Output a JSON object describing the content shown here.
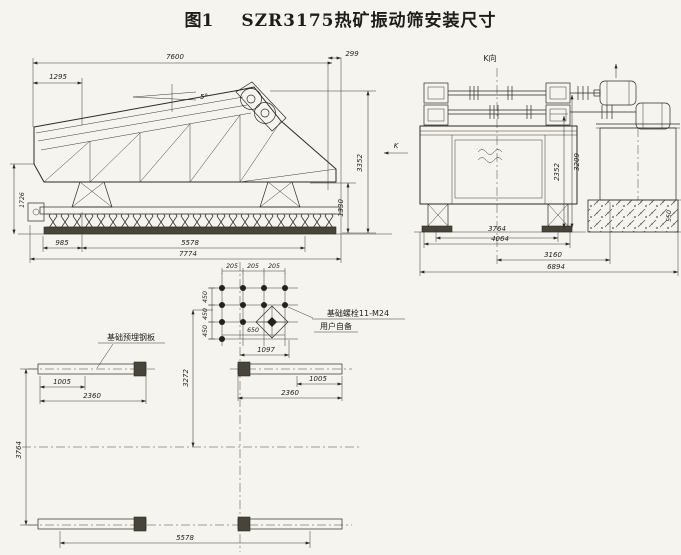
{
  "palette": {
    "paper": "#f6f4ee",
    "ink": "#2b2a26"
  },
  "figure": {
    "label": "图1",
    "title": "SZR3175热矿振动筛安装尺寸"
  },
  "side_view": {
    "k_marker": "K",
    "dims": {
      "overall_length": "7600",
      "feed_offset": "1295",
      "rear_offset": "299",
      "incline_angle": "5°",
      "overall_height": "3352",
      "discharge_height": "1330",
      "left_height": "1726",
      "base_front": "985",
      "base_span": "5578",
      "base_overall": "7774"
    }
  },
  "end_view": {
    "view_label": "K向",
    "dims": {
      "bearing_span": "3764",
      "outer_span": "4064",
      "motor_span": "3160",
      "overall_width": "6894",
      "shaft_height": "2352",
      "motor_height": "3209",
      "block_height": "550"
    }
  },
  "plan_view": {
    "plate_note": "基础预埋钢板",
    "bolt_note_line1": "基础螺栓11-M24",
    "bolt_note_line2": "用户自备",
    "dims": {
      "col_spacing": [
        "205",
        "205",
        "205"
      ],
      "row_spacing": [
        "450",
        "450",
        "450"
      ],
      "group_width": "650",
      "to_plate": "1097",
      "axis_offset": "3272",
      "plate_inner_left": "1005",
      "plate_left": "2360",
      "plate_inner_right": "1005",
      "plate_right": "2360",
      "row_span": "3764",
      "overall": "5578"
    }
  }
}
